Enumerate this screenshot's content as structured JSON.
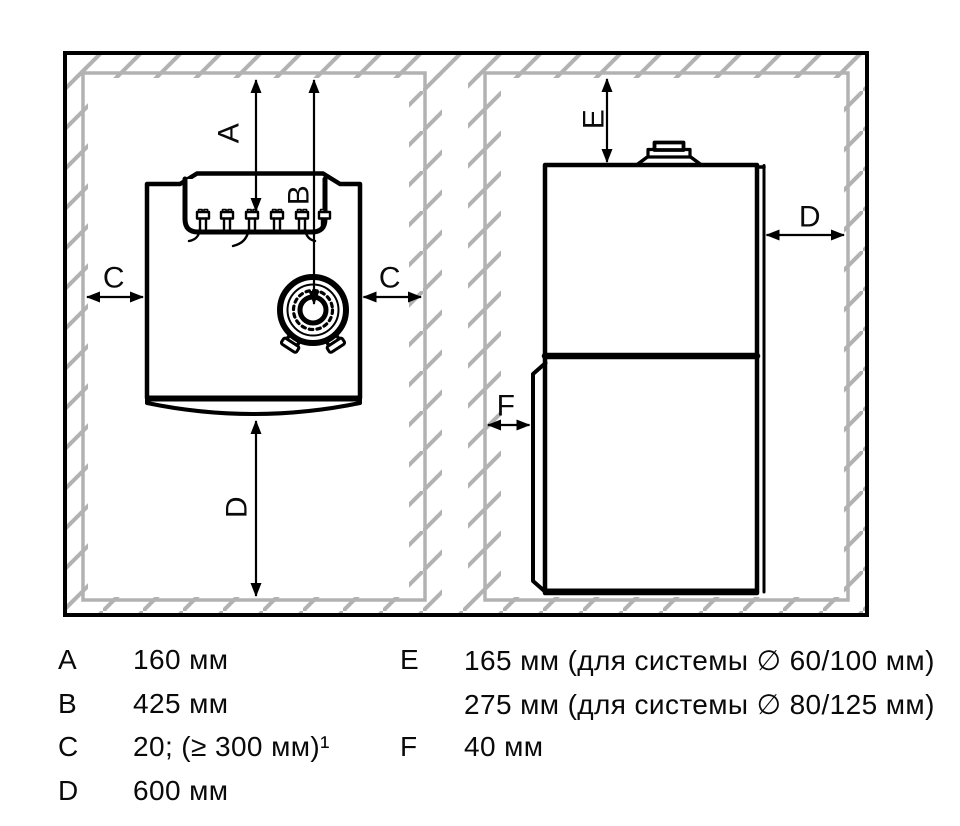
{
  "figure": {
    "description": "boiler-installation-clearances-diagram",
    "dim_labels": {
      "a": "A",
      "b": "B",
      "c": "C",
      "d": "D",
      "e": "E",
      "f": "F"
    }
  },
  "legend": {
    "rows_left": [
      {
        "key": "A",
        "value": "160 мм"
      },
      {
        "key": "B",
        "value": "425 мм"
      },
      {
        "key": "C",
        "value": "20; (≥ 300 мм)¹"
      },
      {
        "key": "D",
        "value": "600 мм"
      }
    ],
    "rows_right": [
      {
        "key": "E",
        "value": "165 мм (для системы ∅ 60/100 мм)"
      },
      {
        "key": "",
        "value": "275 мм (для системы ∅ 80/125 мм)"
      },
      {
        "key": "F",
        "value": "40 мм"
      }
    ]
  },
  "colors": {
    "wall_hatch_gray": "#b2b2b2",
    "line_black": "#000000",
    "background": "#ffffff"
  }
}
